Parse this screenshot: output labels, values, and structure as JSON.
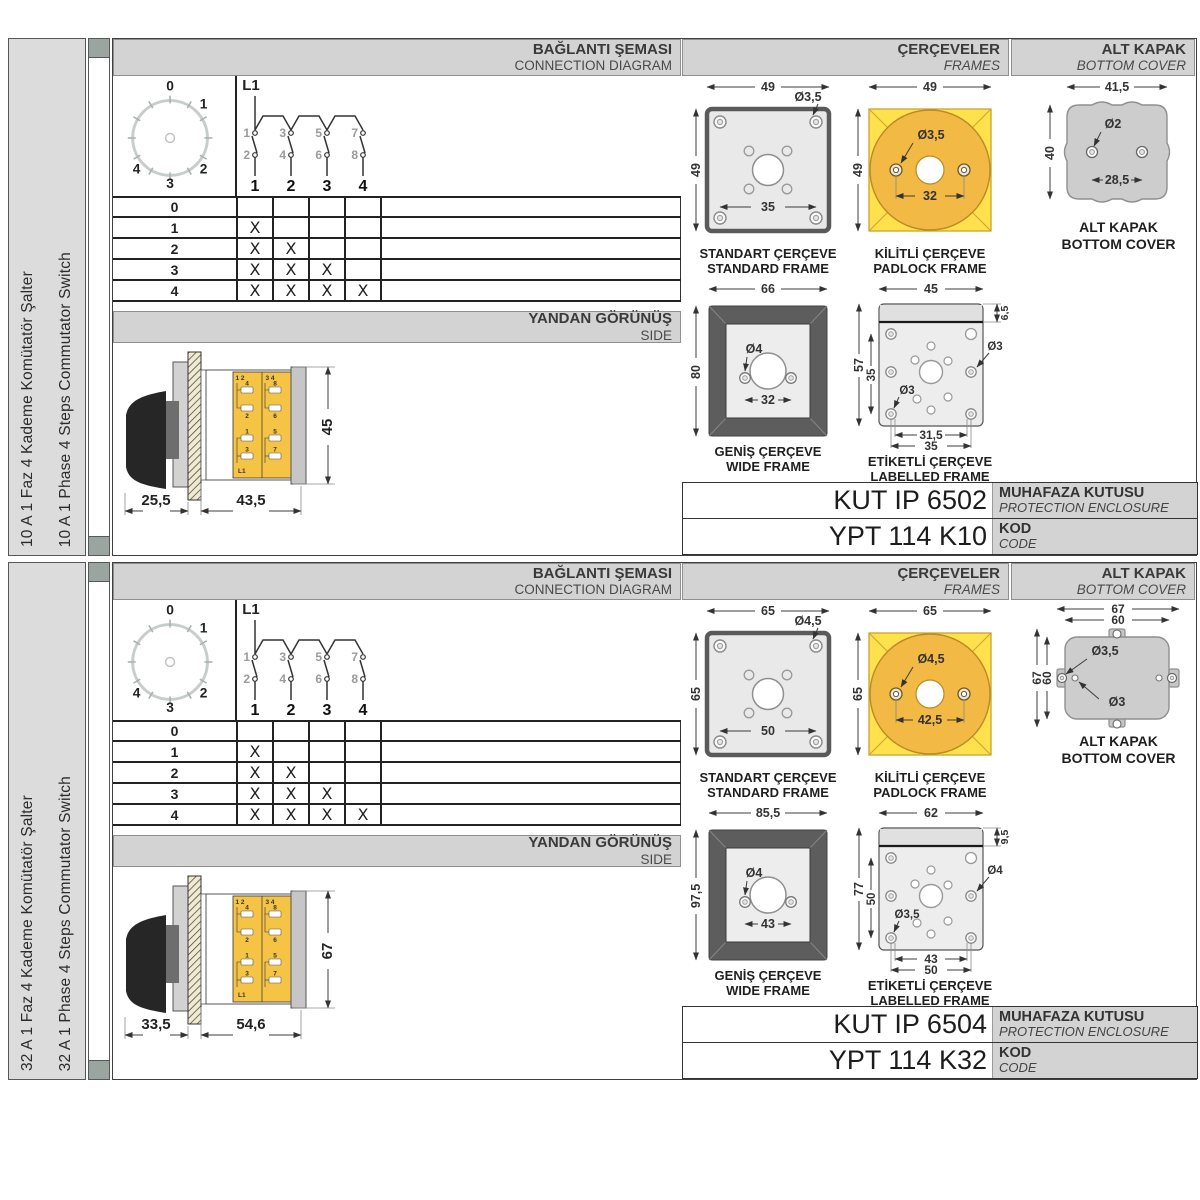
{
  "labels": {
    "connection_tr": "BAĞLANTI ŞEMASI",
    "connection_en": "CONNECTION DIAGRAM",
    "frames_tr": "ÇERÇEVELER",
    "frames_en": "FRAMES",
    "bottom_cover_tr": "ALT KAPAK",
    "bottom_cover_en": "BOTTOM COVER",
    "side_tr": "YANDAN GÖRÜNÜŞ",
    "side_en": "SIDE",
    "standard_tr": "STANDART ÇERÇEVE",
    "standard_en": "STANDARD FRAME",
    "padlock_tr": "KİLİTLİ ÇERÇEVE",
    "padlock_en": "PADLOCK FRAME",
    "wide_tr": "GENİŞ ÇERÇEVE",
    "wide_en": "WIDE FRAME",
    "labelled_tr": "ETİKETLİ ÇERÇEVE",
    "labelled_en": "LABELLED FRAME",
    "enclosure_tr": "MUHAFAZA KUTUSU",
    "enclosure_en": "PROTECTION ENCLOSURE",
    "code_tr": "KOD",
    "code_en": "CODE"
  },
  "diagram": {
    "dial_labels": [
      "0",
      "1",
      "2",
      "3",
      "4"
    ],
    "line_label": "L1",
    "top_contacts": [
      "1",
      "3",
      "5",
      "7"
    ],
    "bottom_contacts": [
      "2",
      "4",
      "6",
      "8"
    ],
    "outputs": [
      "1",
      "2",
      "3",
      "4"
    ],
    "steps": [
      "0",
      "1",
      "2",
      "3",
      "4"
    ],
    "marks": [
      [
        "",
        "",
        "",
        ""
      ],
      [
        "X",
        "",
        "",
        ""
      ],
      [
        "X",
        "X",
        "",
        ""
      ],
      [
        "X",
        "X",
        "X",
        ""
      ],
      [
        "X",
        "X",
        "X",
        "X"
      ]
    ]
  },
  "side_view_block": {
    "pair_left": "1 2",
    "pair_right": "3 4",
    "terminals": [
      "4",
      "2",
      "8",
      "6",
      "1",
      "3",
      "5",
      "7"
    ],
    "line_label": "L1"
  },
  "sections": [
    {
      "title_tr": "10 A 1 Faz 4 Kademe Komütatör Şalter",
      "title_en": "10 A 1 Phase 4 Steps Commutator Switch",
      "side_view": {
        "depth_handle": "25,5",
        "depth_body": "43,5",
        "height": "45"
      },
      "standard_frame": {
        "w": "49",
        "h": "49",
        "hole": "Ø3,5",
        "span": "35"
      },
      "padlock_frame": {
        "w": "49",
        "h": "49",
        "hole": "Ø3,5",
        "span": "32"
      },
      "wide_frame": {
        "w": "66",
        "h": "80",
        "hole": "Ø4",
        "span": "32"
      },
      "labelled_frame": {
        "w": "45",
        "strip": "6,5",
        "h": "57",
        "inner_h": "35",
        "hole_right": "Ø3",
        "hole_left": "Ø3",
        "span1": "31,5",
        "span2": "35"
      },
      "bottom_cover": {
        "w": "41,5",
        "h": "40",
        "hole": "Ø2",
        "span": "28,5"
      },
      "enclosure_code": "KUT IP 6502",
      "product_code": "YPT 114 K10"
    },
    {
      "title_tr": "32 A 1 Faz 4 Kademe Komütatör Şalter",
      "title_en": "32 A 1 Phase 4 Steps Commutator Switch",
      "side_view": {
        "depth_handle": "33,5",
        "depth_body": "54,6",
        "height": "67"
      },
      "standard_frame": {
        "w": "65",
        "h": "65",
        "hole": "Ø4,5",
        "span": "50"
      },
      "padlock_frame": {
        "w": "65",
        "h": "65",
        "hole": "Ø4,5",
        "span": "42,5"
      },
      "wide_frame": {
        "w": "85,5",
        "h": "97,5",
        "hole": "Ø4",
        "span": "43"
      },
      "labelled_frame": {
        "w": "62",
        "strip": "9,5",
        "h": "77",
        "inner_h": "50",
        "hole_right": "Ø4",
        "hole_left": "Ø3,5",
        "span1": "43",
        "span2": "50"
      },
      "bottom_cover": {
        "w_outer": "67",
        "w_inner": "60",
        "h_outer": "67",
        "h_inner": "60",
        "hole_big": "Ø3,5",
        "hole_small": "Ø3"
      },
      "enclosure_code": "KUT IP 6504",
      "product_code": "YPT 114 K32"
    }
  ],
  "colors": {
    "accent_yellow": "#FFE14D",
    "accent_orange": "#F3B945",
    "band_gray": "#D3D3D3",
    "strip_green": "#9BA59F"
  }
}
